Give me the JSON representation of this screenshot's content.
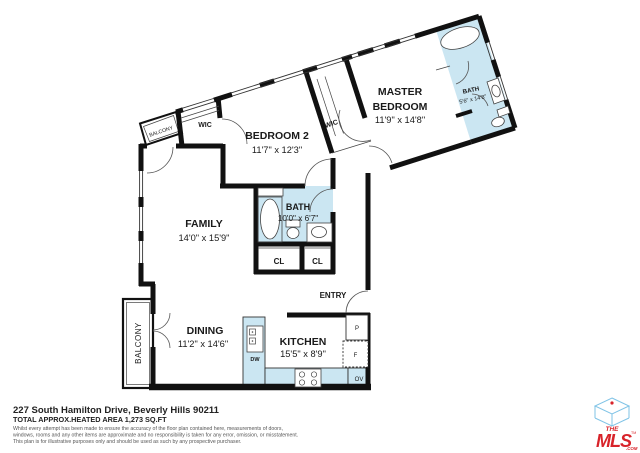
{
  "plan": {
    "rooms": {
      "family": {
        "name": "FAMILY",
        "dims": "14'0\" x 15'9\""
      },
      "dining": {
        "name": "DINING",
        "dims": "11'2\" x 14'6\""
      },
      "kitchen": {
        "name": "KITCHEN",
        "dims": "15'5\" x 8'9\""
      },
      "bath": {
        "name": "BATH",
        "dims": "10'0\" x 6'7\""
      },
      "master_bath": {
        "name": "BATH",
        "dims": "5'6\" x 14'8\""
      },
      "bedroom2": {
        "name": "BEDROOM 2",
        "dims": "11'7\" x 12'3\""
      },
      "master": {
        "line1": "MASTER",
        "line2": "BEDROOM",
        "dims": "11'9\" x 14'8\""
      }
    },
    "labels": {
      "entry": "ENTRY",
      "balcony_top": "BALCONY",
      "balcony_left": "BALCONY",
      "wic_top": "WIC",
      "wic_mid": "WIC",
      "closet_left": "CL",
      "closet_right": "CL"
    },
    "appliances": {
      "dishwasher": "DW",
      "pantry": "P",
      "fridge": "F",
      "oven": "OV"
    }
  },
  "footer": {
    "address": "227 South Hamilton Drive, Beverly Hills 90211",
    "area": "TOTAL APPROX.HEATED AREA 1,273 SQ.FT",
    "disclaimer_line1": "Whilst every attempt has been made to ensure the accuracy of the floor plan contained here, measurements of doors,",
    "disclaimer_line2": "windows, rooms and any other items are approximate and no responsibility is taken for any error, omission, or misstatement.",
    "disclaimer_line3": "This plan is for illustrative purposes only and should be used as such by any prospective purchaser."
  },
  "logo": {
    "the": "THE",
    "mls": "MLS",
    "com": ".COM",
    "tm": "TM"
  },
  "colors": {
    "wall": "#111111",
    "fixture_blue": "#cbe6f2",
    "logo_red": "#d8232a",
    "logo_blue": "#7fc3e6"
  }
}
